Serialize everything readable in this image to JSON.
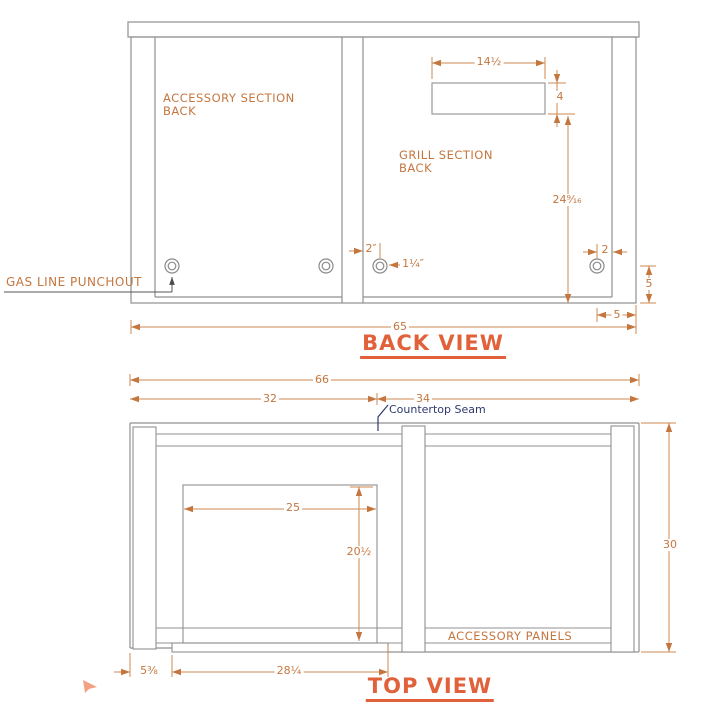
{
  "colors": {
    "accent_orange": "#c4763f",
    "title_orange": "#e0613a",
    "drawing_gray": "#909090",
    "seam_navy": "#2e3a6e"
  },
  "back_view": {
    "title": "BACK VIEW",
    "labels": {
      "accessory_section": "ACCESSORY SECTION BACK",
      "grill_section": "GRILL SECTION BACK",
      "gas_line": "GAS LINE PUNCHOUT"
    },
    "dims": {
      "cutout_width": "14½",
      "cutout_height": "4",
      "cutout_to_base": "24⁹⁄₁₆",
      "left_punchout_inset": "2″",
      "punchout_diameter": "1¼″",
      "right_punchout_inset": "2",
      "right_corner_height": "5",
      "right_corner_width": "5",
      "overall_width": "65"
    }
  },
  "top_view": {
    "title": "TOP VIEW",
    "labels": {
      "countertop_seam": "Countertop Seam",
      "accessory_panels": "ACCESSORY PANELS"
    },
    "dims": {
      "overall_width": "66",
      "accessory_section_width": "32",
      "grill_section_width": "34",
      "overall_depth": "30",
      "opening_width": "25",
      "opening_depth": "20½",
      "base_notch_width": "28¼",
      "base_notch_inset": "5⅜"
    }
  }
}
